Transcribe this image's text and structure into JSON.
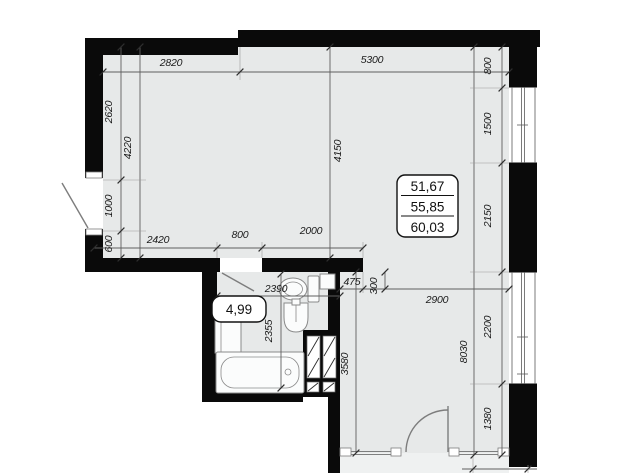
{
  "areas": {
    "living": "51,67",
    "usable": "55,85",
    "total": "60,03",
    "bathroom": "4,99"
  },
  "dimensions": {
    "top_left": "2820",
    "top_right": "5300",
    "left_upper": "2620",
    "left_door": "1000",
    "left_lower": "600",
    "left_overall": "4220",
    "living_height": "4150",
    "right_s1": "800",
    "right_s2": "1500",
    "right_s3": "2150",
    "right_s4": "2200",
    "right_s5": "1380",
    "right_overall": "8030",
    "hall_wall": "2420",
    "hall_door": "800",
    "hall_wall2": "2000",
    "bath_width": "2390",
    "bath_depth": "2355",
    "nook": "475",
    "offset": "300",
    "kitchen_width": "2900",
    "kitchen_depth": "3580"
  },
  "colors": {
    "wall": "#0a0a0a",
    "floor": "#e7e9e9",
    "floor_light": "#eff1f1",
    "dim_line": "#5f5f5f",
    "fixture_line": "#8a8a8a",
    "text": "#1b1b1b"
  }
}
